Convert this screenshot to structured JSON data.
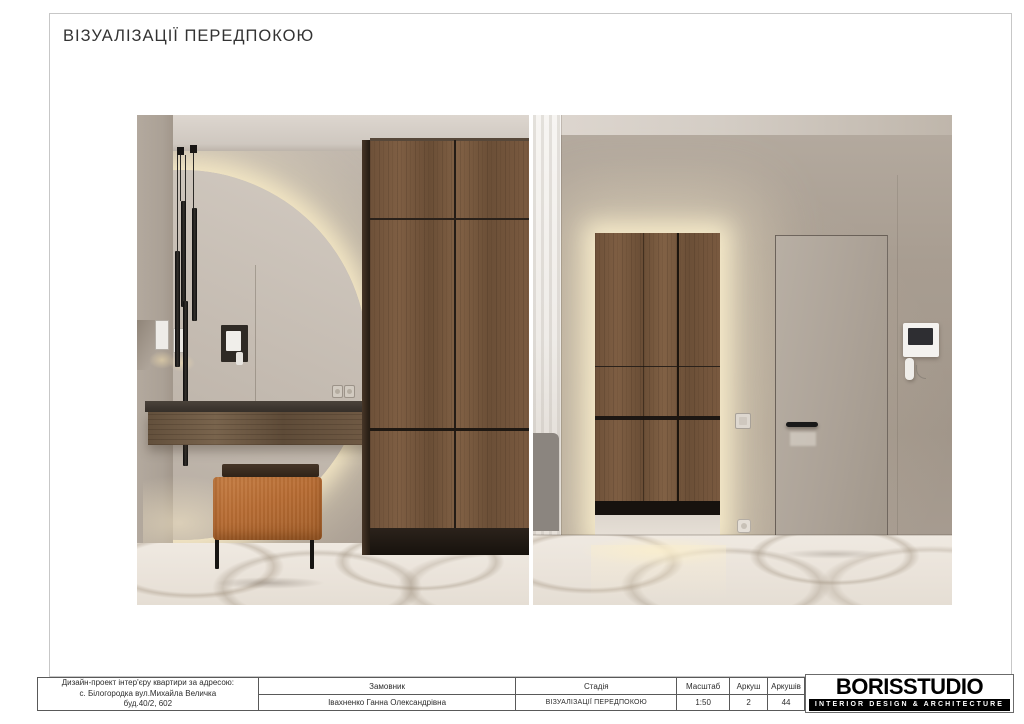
{
  "page": {
    "title": "ВІЗУАЛІЗАЦІЇ ПЕРЕДПОКОЮ"
  },
  "title_block": {
    "project": {
      "line1": "Дизайн-проект інтер'єру квартири за адресою:",
      "line2": "с. Білогородка вул.Михайла Величка",
      "line3": "буд.40/2, 602"
    },
    "client": {
      "header": "Замовник",
      "value": "Івахненко Ганна Олександрівна"
    },
    "stage": {
      "header": "Стадія",
      "value": "ВІЗУАЛІЗАЦІЇ ПЕРЕДПОКОЮ"
    },
    "scale": {
      "header": "Масштаб",
      "value": "1:50"
    },
    "sheet": {
      "header": "Аркуш",
      "value": "2"
    },
    "sheets_total": {
      "header": "Аркушів",
      "value": "44"
    },
    "logo": {
      "name": "BORISSTUDIO",
      "tagline": "INTERIOR DESIGN & ARCHITECTURE"
    }
  },
  "renders": [
    {
      "name": "hallway-console-view",
      "description": "Hallway render: backlit round mirror, black pendant lights, floating wood console with orange bench, wood wardrobe, marble floor"
    },
    {
      "name": "hallway-entrance-view",
      "description": "Entrance render: backlit rectangular mirror reflecting wood wardrobe, concealed greige door with black handle, video intercom, marble floor"
    }
  ],
  "colors": {
    "led_glow": "#f6e9c6",
    "wall_greige": "#ab9f93",
    "wood_brown": "#74553c",
    "bench_orange": "#b76c33",
    "marble_floor": "#eae3da",
    "logo_bar": "#000000"
  }
}
